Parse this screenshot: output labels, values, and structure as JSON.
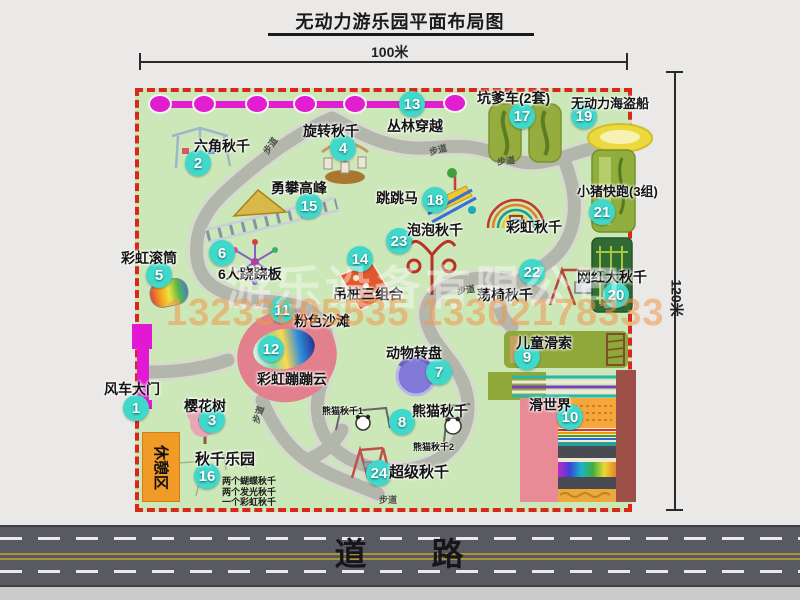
{
  "title": "无动力游乐园平面布局图",
  "dimensions": {
    "width": "100米",
    "height": "120米"
  },
  "road": {
    "label": "道 路"
  },
  "rest_area_label": "休憩区",
  "path_label": "步道",
  "watermark": {
    "company": "游乐设备有限公司",
    "phones": "13233805535 13302178333"
  },
  "extra_labels": {
    "rainbow_swing": "彩虹秋千",
    "panda_swing_1": "熊猫秋千1",
    "panda_swing_2": "熊猫秋千2"
  },
  "swing_park_notes": [
    "两个蝴蝶秋千",
    "两个发光秋千",
    "一个彩虹秋千"
  ],
  "attractions": [
    {
      "num": "1",
      "label": "风车大门"
    },
    {
      "num": "2",
      "label": "六角秋千"
    },
    {
      "num": "3",
      "label": "樱花树"
    },
    {
      "num": "4",
      "label": "旋转秋千"
    },
    {
      "num": "5",
      "label": "彩虹滚筒"
    },
    {
      "num": "6",
      "label": "6人跷跷板"
    },
    {
      "num": "7",
      "label": "动物转盘"
    },
    {
      "num": "8",
      "label": "熊猫秋千"
    },
    {
      "num": "9",
      "label": "儿童滑索"
    },
    {
      "num": "10",
      "label": "滑世界"
    },
    {
      "num": "11",
      "label": "粉色沙滩"
    },
    {
      "num": "12",
      "label": "彩虹蹦蹦云"
    },
    {
      "num": "13",
      "label": "丛林穿越"
    },
    {
      "num": "14",
      "label": "吊桩三组合"
    },
    {
      "num": "15",
      "label": "勇攀高峰"
    },
    {
      "num": "16",
      "label": "秋千乐园"
    },
    {
      "num": "17",
      "label": "坑爹车(2套)"
    },
    {
      "num": "18",
      "label": "跳跳马"
    },
    {
      "num": "19",
      "label": "无动力海盗船"
    },
    {
      "num": "20",
      "label": "网红大秋千"
    },
    {
      "num": "21",
      "label": "小猪快跑(3组)"
    },
    {
      "num": "22",
      "label": "荡椅秋千"
    },
    {
      "num": "23",
      "label": "泡泡秋千"
    },
    {
      "num": "24",
      "label": "超级秋千"
    }
  ]
}
